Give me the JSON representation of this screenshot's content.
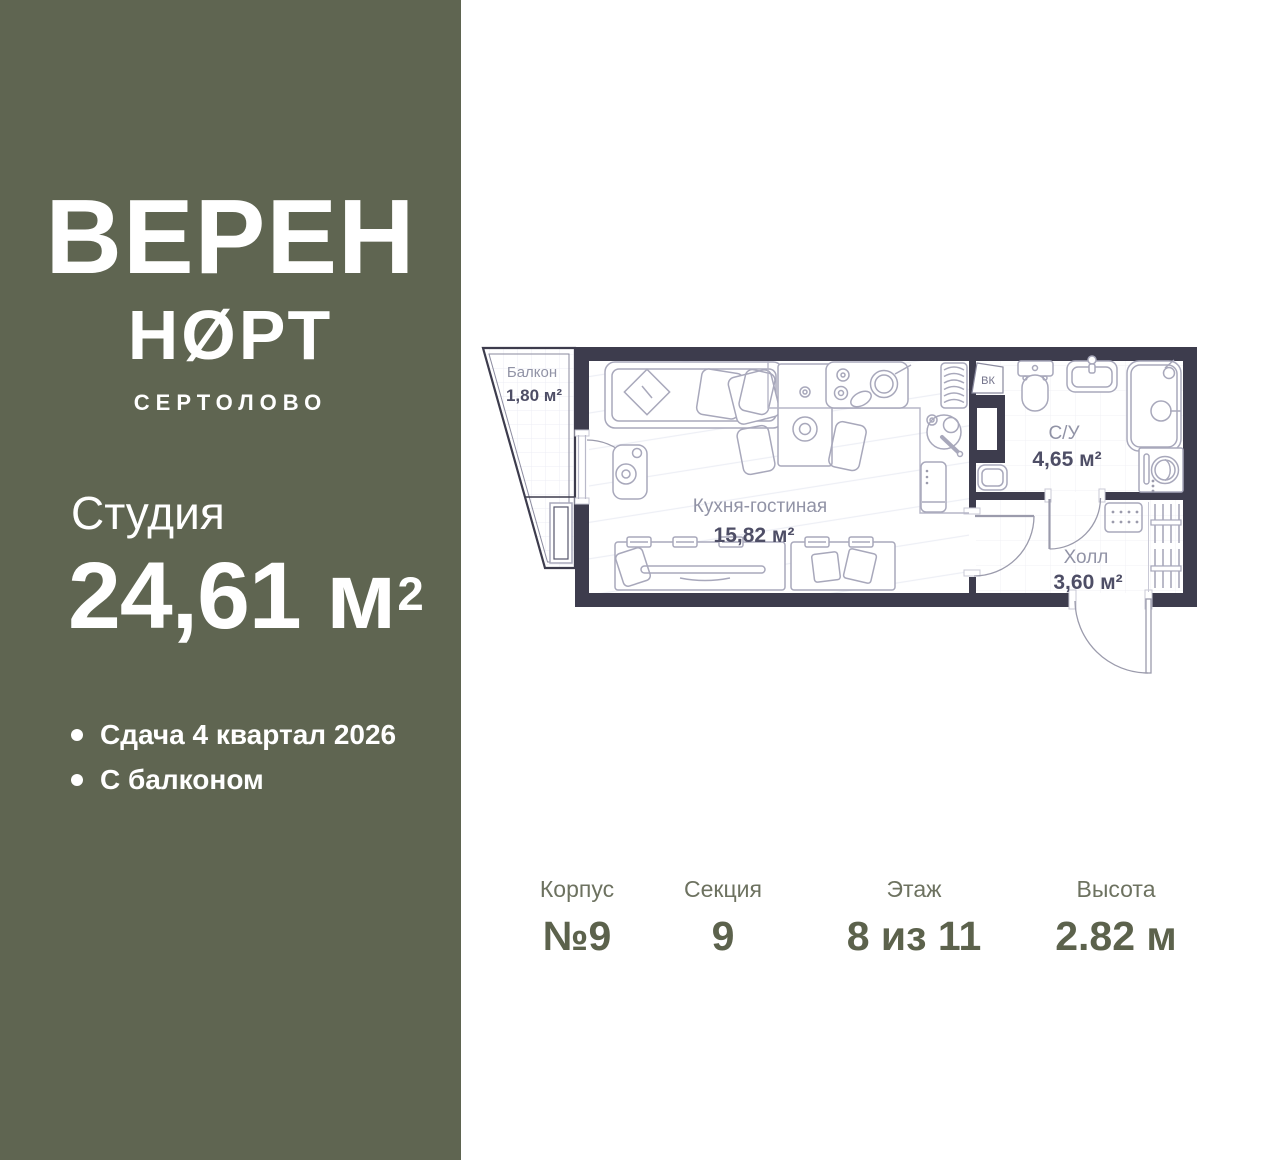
{
  "sidebar": {
    "logo_line1": "ВЕРЕН",
    "logo_line2": "НØРТ",
    "logo_city": "СЕРТОЛОВО",
    "unit_type": "Студия",
    "area_value": "24,61",
    "area_unit": "м",
    "area_sup": "2",
    "features": [
      {
        "label": "Сдача 4 квартал 2026"
      },
      {
        "label": "С балконом"
      }
    ]
  },
  "plan": {
    "rooms": [
      {
        "name": "Балкон",
        "area": "1,80 м²"
      },
      {
        "name": "Кухня-гостиная",
        "area": "15,82 м²"
      },
      {
        "name": "С/У",
        "area": "4,65 м²"
      },
      {
        "name": "Холл",
        "area": "3,60 м²"
      }
    ],
    "shaft_label": "ВК"
  },
  "footer": {
    "columns": [
      {
        "label": "Корпус",
        "value": "№9"
      },
      {
        "label": "Секция",
        "value": "9"
      },
      {
        "label": "Этаж",
        "value": "8 из 11"
      },
      {
        "label": "Высота",
        "value": "2.82 м"
      }
    ]
  },
  "colors": {
    "sidebar_bg": "#5f6551",
    "wall": "#3d3c4d",
    "room_label": "#9193a6",
    "room_area": "#4e4e66",
    "footer_label": "#6d7260",
    "footer_value": "#5c624c"
  }
}
